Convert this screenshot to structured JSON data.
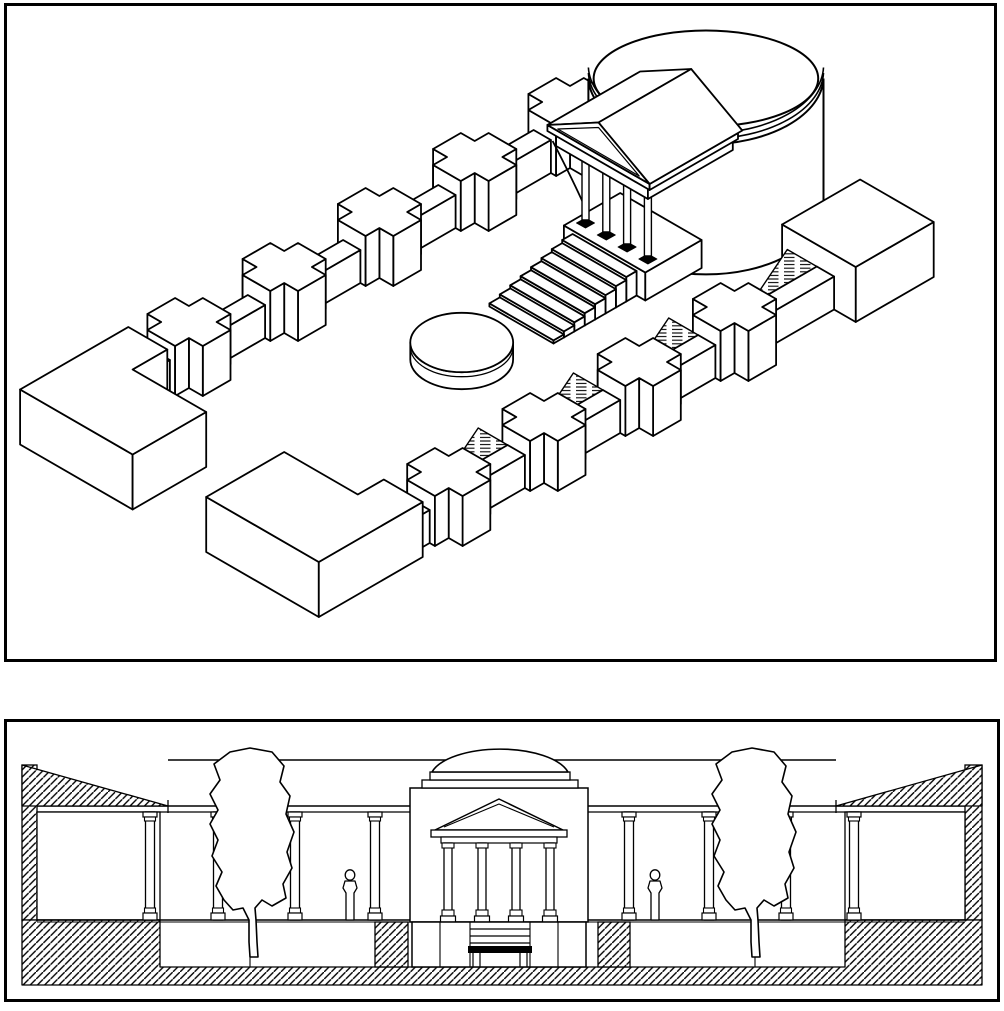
{
  "colors": {
    "ink": "#000000",
    "paper": "#ffffff"
  },
  "layout": {
    "width": 1004,
    "height": 1011
  },
  "panels": {
    "axonometric": {
      "x": 4,
      "y": 3,
      "width": 993,
      "height": 659,
      "border": 3
    },
    "section": {
      "x": 4,
      "y": 719,
      "width": 996,
      "height": 283,
      "border": 3
    }
  },
  "axo": {
    "iso": {
      "ox": 85,
      "oy": 432,
      "scale": 100
    },
    "pier": {
      "arm": 0.16,
      "half": 0.32,
      "height": 0.5
    },
    "link": {
      "height": 0.33,
      "halfWidth": 0.1
    },
    "ramp": {
      "length": 0.42,
      "v0": 2.56,
      "v1": 2.9,
      "height": 0.33
    },
    "nw": {
      "v": 0,
      "piers": [
        1.2,
        2.3,
        3.4,
        4.5,
        5.6
      ],
      "links": [
        [
          0.62,
          0.88
        ],
        [
          1.52,
          1.98
        ],
        [
          2.62,
          3.08
        ],
        [
          3.72,
          4.18
        ],
        [
          4.82,
          5.28
        ]
      ]
    },
    "se": {
      "v": 3,
      "piers": [
        1.2,
        2.3,
        3.4,
        4.5
      ],
      "links": [
        [
          0.7,
          0.88
        ],
        [
          1.52,
          1.98
        ],
        [
          2.62,
          3.08
        ],
        [
          3.72,
          4.18
        ],
        [
          4.82,
          5.55
        ]
      ],
      "ramps": [
        0.88,
        1.98,
        3.08,
        4.18,
        5.55
      ]
    },
    "blocks": {
      "west": {
        "plan": [
          [
            -0.5,
            -0.25
          ],
          [
            0.75,
            -0.25
          ],
          [
            0.75,
            0.2
          ],
          [
            0.35,
            0.2
          ],
          [
            0.35,
            1.05
          ],
          [
            -0.5,
            1.05
          ]
        ],
        "height": 0.55
      },
      "south": {
        "plan": [
          [
            -0.5,
            1.9
          ],
          [
            0.4,
            1.9
          ],
          [
            0.4,
            2.75
          ],
          [
            0.7,
            2.75
          ],
          [
            0.7,
            3.2
          ],
          [
            -0.5,
            3.2
          ]
        ],
        "height": 0.55
      },
      "east": {
        "plan": [
          [
            5.55,
            2.5
          ],
          [
            6.45,
            2.5
          ],
          [
            6.45,
            3.35
          ],
          [
            5.55,
            3.35
          ]
        ],
        "height": 0.55
      }
    },
    "rotunda": {
      "u": 5.82,
      "v": 1.35,
      "r": 0.96,
      "drumTop": 1.3,
      "domeRise": 0.48,
      "domeRxRatio": 0.955,
      "bandOffset": 5.5
    },
    "portico": {
      "front": 4.52,
      "back": 5.5,
      "colU": 4.68,
      "colVs": [
        1.1,
        1.34,
        1.58,
        1.82
      ],
      "podium": {
        "u0": 4.55,
        "u1": 5.2,
        "v0": 0.98,
        "v1": 1.92,
        "h": 0.28
      },
      "entV0": 0.92,
      "entV1": 1.98,
      "entH0": 1.06,
      "entH1": 1.2,
      "corV0": 0.86,
      "corV1": 2.04,
      "corH1": 1.26,
      "apexH": 1.58
    },
    "stairs": {
      "u0": 4.55,
      "stepDu": 0.12,
      "n": 8,
      "v0": 1.08,
      "v1": 1.82,
      "h0": 0.245,
      "dh": 0.0306
    },
    "basin": {
      "u": 2.9,
      "v": 1.45,
      "r": 0.42,
      "h": 0.17
    }
  },
  "section": {
    "backTopY": 760,
    "beamY1": 806,
    "beamY2": 812,
    "floorY": 920,
    "floorY2": 922,
    "courtY": 967,
    "groundY": 985,
    "wallTopY": 765,
    "eaveL": 168,
    "eaveR": 836,
    "leftWall": {
      "x1": 22,
      "x2": 37
    },
    "rightWall": {
      "x1": 965,
      "x2": 982
    },
    "rooms": {
      "left": [
        37,
        160
      ],
      "right": [
        845,
        965
      ]
    },
    "roomCols": [
      150,
      854
    ],
    "midCols": [
      218,
      295,
      375,
      629,
      709,
      786
    ],
    "courtJoints": [
      250,
      755
    ],
    "plinthHatch": [
      [
        375,
        408
      ],
      [
        598,
        630
      ]
    ],
    "figures": [
      350,
      655
    ],
    "trees": [
      250,
      752
    ],
    "temple": {
      "x1": 410,
      "x2": 588,
      "topY": 788,
      "domeSteps": [
        [
          422,
          780,
          156,
          8
        ],
        [
          430,
          772,
          140,
          8
        ]
      ],
      "dome": {
        "x1": 432,
        "x2": 568,
        "baseY": 772,
        "rx": 70,
        "ry": 30
      },
      "pediment": {
        "x1": 435,
        "x2": 563,
        "baseY": 830,
        "apexY": 799
      },
      "innerPediment": {
        "x1": 444,
        "x2": 554,
        "baseY": 827,
        "apexY": 804
      },
      "cornice": [
        431,
        830,
        136,
        7
      ],
      "architrave": [
        441,
        837,
        116,
        6
      ],
      "cols": [
        448,
        482,
        516,
        550
      ],
      "colTopY": 843,
      "colBotY": 916,
      "podium": {
        "x": 412,
        "y": 922,
        "w": 174,
        "h": 45,
        "joints": [
          440,
          470,
          530,
          558
        ]
      },
      "stepLines": [
        929,
        936,
        943
      ],
      "stepX": [
        470,
        530
      ],
      "lintel": [
        468,
        946,
        64,
        7
      ],
      "posts": [
        473,
        480,
        520,
        527
      ]
    }
  }
}
